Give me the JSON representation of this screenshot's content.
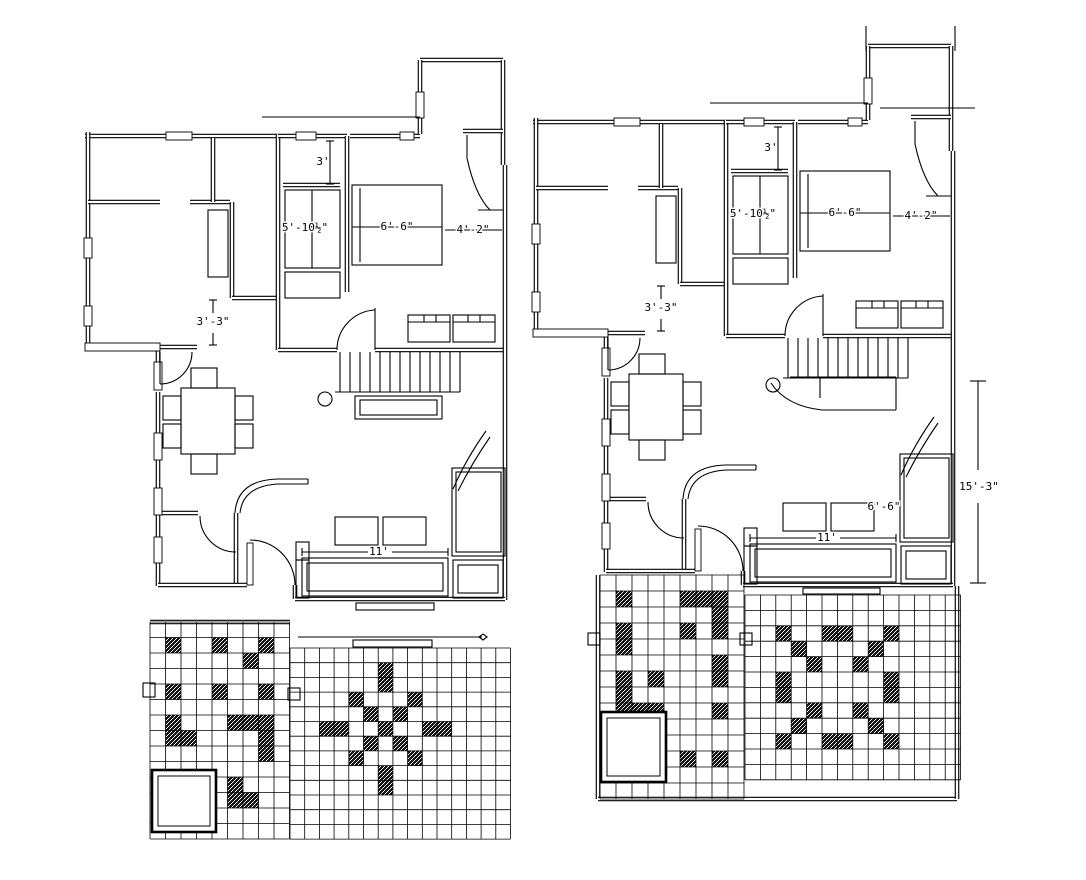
{
  "document": {
    "type": "architectural-floor-plan-drawing",
    "description": "Two ground floor plan variants of a house with furniture layout and patterned floor tiling",
    "background_color": "#ffffff",
    "line_color": "#000000",
    "tile_accent_color": "#161616"
  },
  "plans": [
    {
      "name": "left-plan",
      "dimensions": {
        "closet": "3'",
        "wardrobe": "5'-10½\"",
        "bed": "6'-6\"",
        "bed_clearance": "4'-2\"",
        "passage": "3'-3\"",
        "sofa": "11'"
      },
      "tiles": {
        "left_grid": {
          "cols": 9,
          "rows": 14,
          "dark_cells": [
            [
              1,
              1
            ],
            [
              4,
              1
            ],
            [
              7,
              1
            ],
            [
              6,
              2
            ],
            [
              1,
              4
            ],
            [
              4,
              4
            ],
            [
              7,
              4
            ],
            [
              1,
              6
            ],
            [
              5,
              6
            ],
            [
              6,
              6
            ],
            [
              7,
              6
            ],
            [
              1,
              7
            ],
            [
              2,
              7
            ],
            [
              7,
              7
            ],
            [
              7,
              8
            ],
            [
              5,
              10
            ],
            [
              5,
              11
            ],
            [
              6,
              11
            ]
          ]
        },
        "main_grid": {
          "cols": 15,
          "rows": 13,
          "dark_cells": [
            [
              6,
              1
            ],
            [
              6,
              2
            ],
            [
              4,
              3
            ],
            [
              8,
              3
            ],
            [
              5,
              4
            ],
            [
              7,
              4
            ],
            [
              2,
              5
            ],
            [
              3,
              5
            ],
            [
              6,
              5
            ],
            [
              9,
              5
            ],
            [
              10,
              5
            ],
            [
              5,
              6
            ],
            [
              7,
              6
            ],
            [
              4,
              7
            ],
            [
              8,
              7
            ],
            [
              6,
              8
            ],
            [
              6,
              9
            ]
          ]
        }
      }
    },
    {
      "name": "right-plan",
      "dimensions": {
        "closet": "3'",
        "wardrobe": "5'-10½\"",
        "bed": "6'-6\"",
        "bed_clearance": "4'-2\"",
        "passage": "3'-3\"",
        "sofa": "11'",
        "sofa_depth": "6'-6\"",
        "living_length": "15'-3\""
      },
      "tiles": {
        "left_grid": {
          "cols": 9,
          "rows": 14,
          "dark_cells": [
            [
              1,
              1
            ],
            [
              5,
              1
            ],
            [
              6,
              1
            ],
            [
              7,
              1
            ],
            [
              7,
              2
            ],
            [
              1,
              3
            ],
            [
              5,
              3
            ],
            [
              7,
              3
            ],
            [
              1,
              4
            ],
            [
              7,
              5
            ],
            [
              1,
              6
            ],
            [
              3,
              6
            ],
            [
              7,
              6
            ],
            [
              1,
              7
            ],
            [
              1,
              8
            ],
            [
              2,
              8
            ],
            [
              3,
              8
            ],
            [
              7,
              8
            ],
            [
              5,
              11
            ],
            [
              7,
              11
            ]
          ]
        },
        "main_grid": {
          "cols": 14,
          "rows": 12,
          "dark_cells": [
            [
              2,
              2
            ],
            [
              5,
              2
            ],
            [
              6,
              2
            ],
            [
              9,
              2
            ],
            [
              3,
              3
            ],
            [
              8,
              3
            ],
            [
              4,
              4
            ],
            [
              7,
              4
            ],
            [
              2,
              5
            ],
            [
              9,
              5
            ],
            [
              2,
              6
            ],
            [
              9,
              6
            ],
            [
              4,
              7
            ],
            [
              7,
              7
            ],
            [
              3,
              8
            ],
            [
              8,
              8
            ],
            [
              2,
              9
            ],
            [
              5,
              9
            ],
            [
              6,
              9
            ],
            [
              9,
              9
            ]
          ]
        }
      }
    }
  ]
}
